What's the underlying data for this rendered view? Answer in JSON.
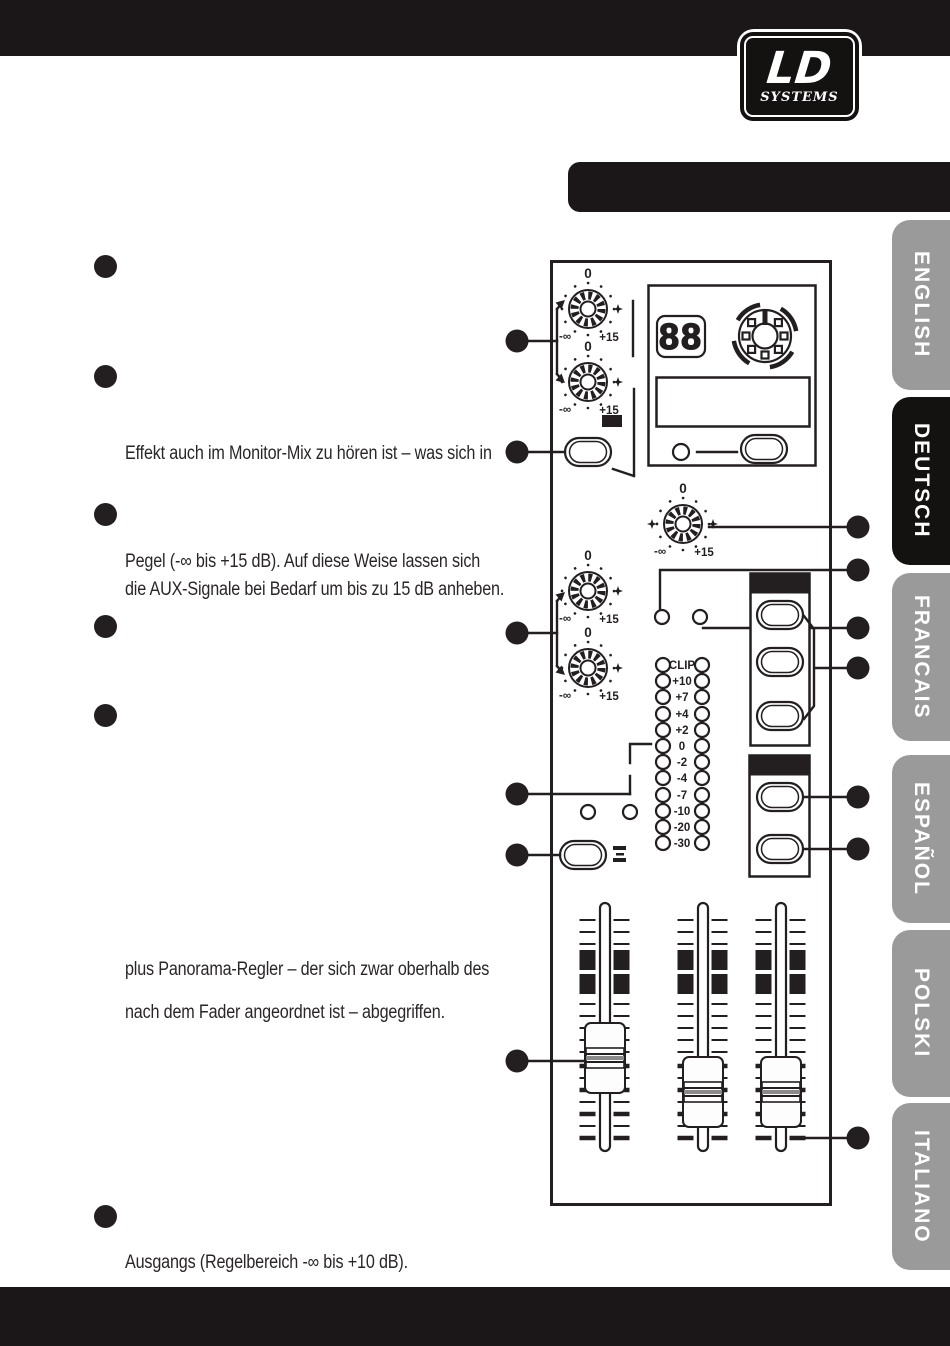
{
  "logo": {
    "brand": "LD",
    "sub": "SYSTEMS"
  },
  "tabs": [
    {
      "label": "ENGLISH",
      "active": false
    },
    {
      "label": "DEUTSCH",
      "active": true
    },
    {
      "label": "FRANCAIS",
      "active": false
    },
    {
      "label": "ESPAÑOL",
      "active": false
    },
    {
      "label": "POLSKI",
      "active": false
    },
    {
      "label": "ITALIANO",
      "active": false
    }
  ],
  "body_text": {
    "p1": "Effekt auch im Monitor-Mix zu hören ist – was sich in",
    "p2_line1": "Pegel (-∞ bis +15 dB). Auf diese Weise lassen sich",
    "p2_line2": "die AUX-Signale bei Bedarf um bis zu 15 dB anheben.",
    "p3_line1": "plus Panorama-Regler – der sich zwar oberhalb des",
    "p3_line2": "nach dem Fader angeordnet ist – abgegriffen.",
    "p4": "Ausgangs (Regelbereich -∞ bis +10 dB)."
  },
  "diagram": {
    "knob": {
      "zero": "0",
      "min": "-∞",
      "max": "+15"
    },
    "display_value": "88",
    "meter_labels": [
      "CLIP",
      "+10",
      "+7",
      "+4",
      "+2",
      "0",
      "-2",
      "-4",
      "-7",
      "-10",
      "-20",
      "-30"
    ]
  },
  "colors": {
    "ink": "#231f20",
    "tab_gray": "#9a9a9a",
    "tab_active": "#141111"
  }
}
